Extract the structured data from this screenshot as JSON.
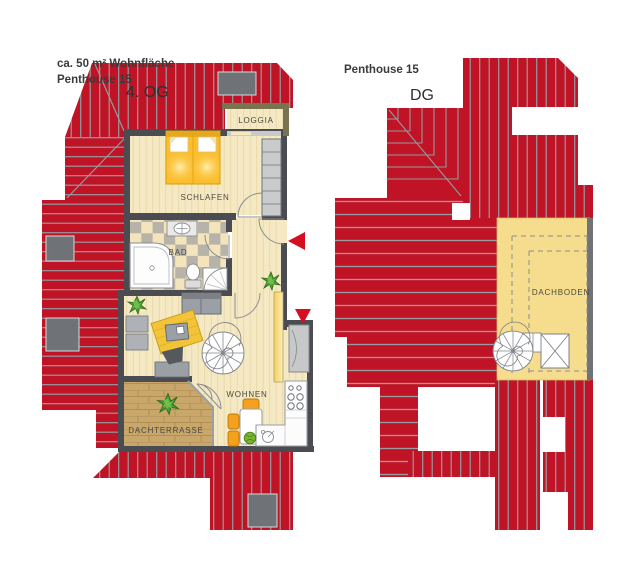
{
  "plan_left": {
    "area_label": "ca. 50 m² Wohnfläche",
    "title": "Penthouse 15",
    "level_label": "4. OG",
    "rooms": {
      "loggia": "LOGGIA",
      "bedroom": "SCHLAFEN",
      "bathroom": "BAD",
      "living": "WOHNEN",
      "roof_terrace": "DACHTERRASSE"
    }
  },
  "plan_right": {
    "title": "Penthouse 15",
    "level_label": "DG",
    "rooms": {
      "attic": "DACHBODEN"
    }
  },
  "colors": {
    "roof_red": "#c11326",
    "roof_hatch_gray": "#97999f",
    "wall_dark": "#4b4b52",
    "loggia_wall_olive": "#77744f",
    "floor_beige": "#f5e9c4",
    "attic_yellow": "#f6dd8d",
    "terrace_wood": "#c9a76b",
    "bed_yellow": "#fcbe2e",
    "chair_orange": "#f5a11d",
    "arrow_red": "#d50f1f",
    "plant_green": "#55a43b",
    "chimney_gray": "#6f7276"
  }
}
